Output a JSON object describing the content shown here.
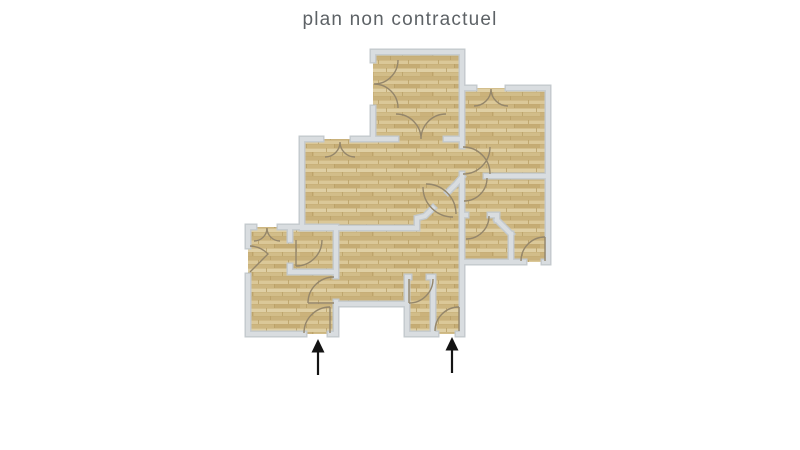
{
  "title": "plan non contractuel",
  "colors": {
    "background": "#ffffff",
    "title_text": "#5d6266",
    "wall_edge": "#c3c9cd",
    "wall_fill": "#d9dde0",
    "wood_base": "#d6c28f",
    "door_arc": "#94866b",
    "arrow": "#141414"
  },
  "icons": {
    "entrance_arrow": "up-arrow"
  }
}
